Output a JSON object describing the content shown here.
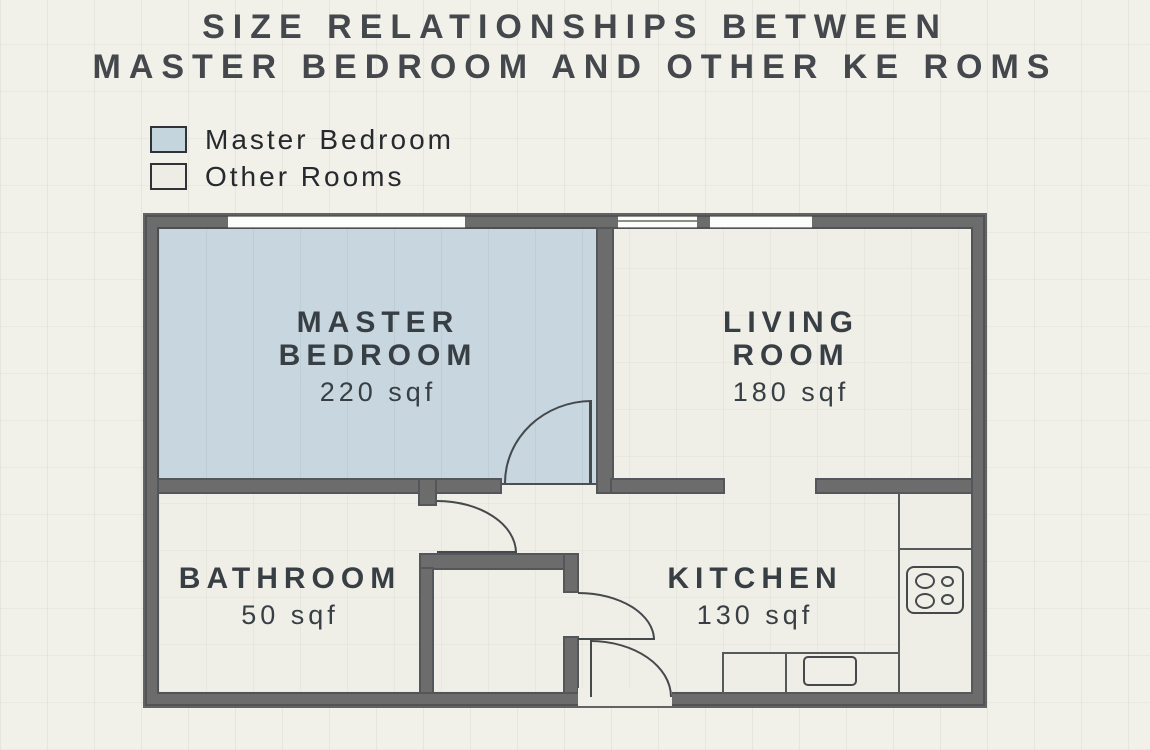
{
  "title": {
    "line1": "SIZE RELATIONSHIPS BETWEEN",
    "line2": "MASTER BEDROOM AND OTHER KE ROMS"
  },
  "legend": {
    "items": [
      {
        "label": "Master Bedroom",
        "swatch_color": "#c5d5de"
      },
      {
        "label": "Other Rooms",
        "swatch_color": "#edece5"
      }
    ]
  },
  "floor_plan": {
    "rooms": {
      "master_bedroom": {
        "name_line1": "MASTER",
        "name_line2": "BEDROOM",
        "area_label": "220 sqf",
        "area_sqf": 220,
        "fill": "#c7d6df"
      },
      "living_room": {
        "name_line1": "LIVING",
        "name_line2": "ROOM",
        "area_label": "180 sqf",
        "area_sqf": 180,
        "fill": "#efeee7"
      },
      "bathroom": {
        "name_line1": "BATHROOM",
        "area_label": "50 sqf",
        "area_sqf": 50,
        "fill": "#efeee7"
      },
      "kitchen": {
        "name_line1": "KITCHEN",
        "area_label": "130 sqf",
        "area_sqf": 130,
        "fill": "#efeee7"
      }
    },
    "fixtures": [
      "stove-4-burners",
      "kitchen-sink",
      "kitchen-counters",
      "door-swings",
      "windows"
    ],
    "colors": {
      "background": "#f1f0e9",
      "wall": "#6c6c6c",
      "wall_edge": "#515457",
      "room_fill": "#efeee7",
      "master_bedroom_fill": "#c7d6df",
      "door_line": "#45494c",
      "window_fill": "#fcfcfa",
      "text": "#44484d"
    }
  }
}
